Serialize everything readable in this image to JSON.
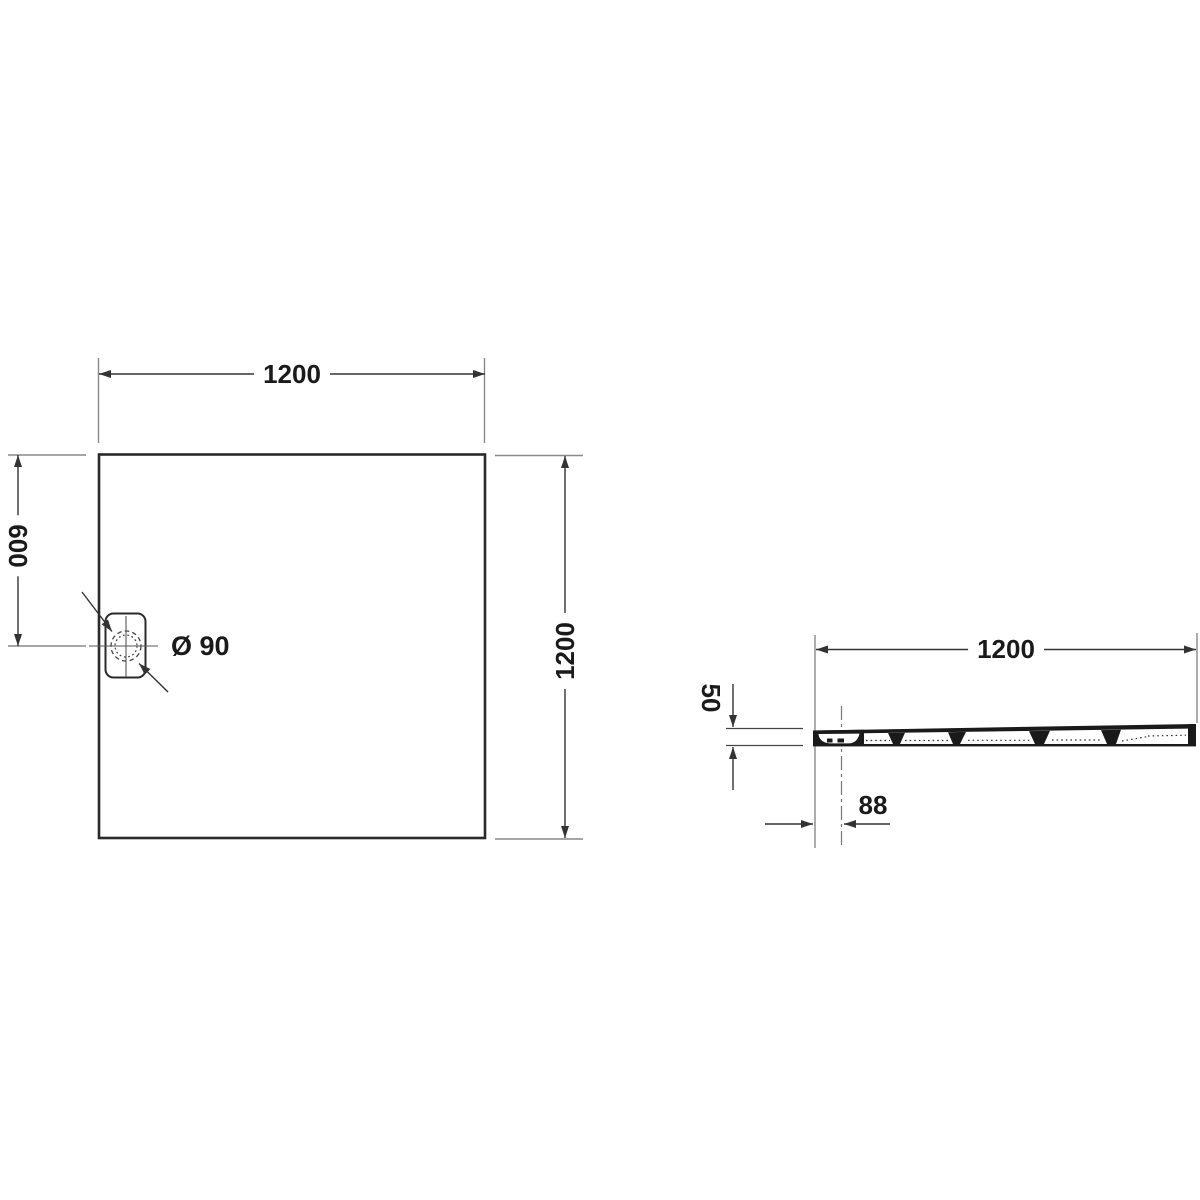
{
  "plan_view": {
    "width_dim": "1200",
    "height_dim": "1200",
    "drain_center_from_top_dim": "600",
    "drain_diameter_dim": "Ø 90"
  },
  "side_view": {
    "width_dim": "1200",
    "height_dim": "50",
    "drain_center_from_edge_dim": "88"
  },
  "colors": {
    "background": "#ffffff",
    "outline": "#2a2a2a",
    "dimension_line": "#333333",
    "extension_line": "#888888",
    "centerline": "#777777",
    "text": "#1a1a1a"
  }
}
